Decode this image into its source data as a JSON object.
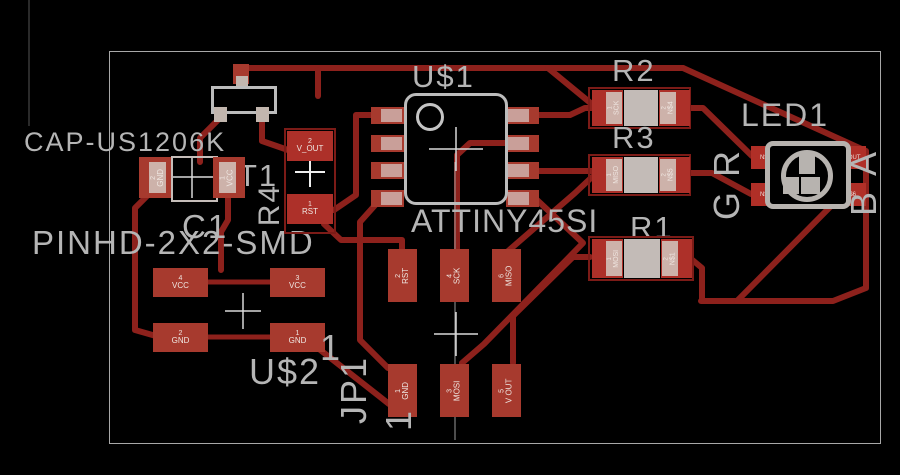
{
  "colors": {
    "trace": "#8d211c",
    "pad": "#a73a2e",
    "pad_inner": "#cdb2aa",
    "silk": "#b5b5b5",
    "board_outline": "#a8a8a8",
    "background": "#000000"
  },
  "components": {
    "t1": {
      "ref": "T1"
    },
    "c1": {
      "ref": "C1",
      "package": "CAP-US1206K",
      "pads": {
        "left_num": "2",
        "left_name": "GND",
        "right_num": "1",
        "right_name": "VCC"
      }
    },
    "u2": {
      "ref": "U$2",
      "package": "PINHD-2X2-SMD",
      "pin1": "1",
      "pads": [
        {
          "num": "4",
          "name": "VCC"
        },
        {
          "num": "3",
          "name": "VCC"
        },
        {
          "num": "2",
          "name": "GND"
        },
        {
          "num": "1",
          "name": "GND"
        }
      ]
    },
    "jp1": {
      "ref": "JP1",
      "pin1": "1",
      "pads": [
        {
          "num": "2",
          "name": "RST"
        },
        {
          "num": "4",
          "name": "SCK"
        },
        {
          "num": "6",
          "name": "MISO"
        },
        {
          "num": "1",
          "name": "GND"
        },
        {
          "num": "3",
          "name": "MOSI"
        },
        {
          "num": "5",
          "name": "V OUT"
        }
      ]
    },
    "u1": {
      "ref": "U$1",
      "value": "ATTINY45SI"
    },
    "r4": {
      "ref": "R4",
      "pads": {
        "top_num": "2",
        "top_name": "V_OUT",
        "bottom_num": "1",
        "bottom_name": "RST"
      }
    },
    "r2": {
      "ref": "R2",
      "pads": {
        "left_num": "1",
        "left_name": "SCK",
        "right_num": "2",
        "right_name": "N$4"
      }
    },
    "r3": {
      "ref": "R3",
      "pads": {
        "left_num": "1",
        "left_name": "MISO",
        "right_num": "2",
        "right_name": "N$5"
      }
    },
    "r1": {
      "ref": "R1",
      "pads": {
        "left_num": "1",
        "left_name": "MOSI",
        "right_num": "2",
        "right_name": "N$1"
      }
    },
    "led1": {
      "ref": "LED1",
      "pads": {
        "tl": "N$4",
        "bl": "N$5",
        "tr": "V_OUT",
        "br": "N$6"
      },
      "pins": {
        "left_top": "R",
        "left_bottom": "G",
        "right_top": "A",
        "right_bottom": "B"
      }
    }
  }
}
